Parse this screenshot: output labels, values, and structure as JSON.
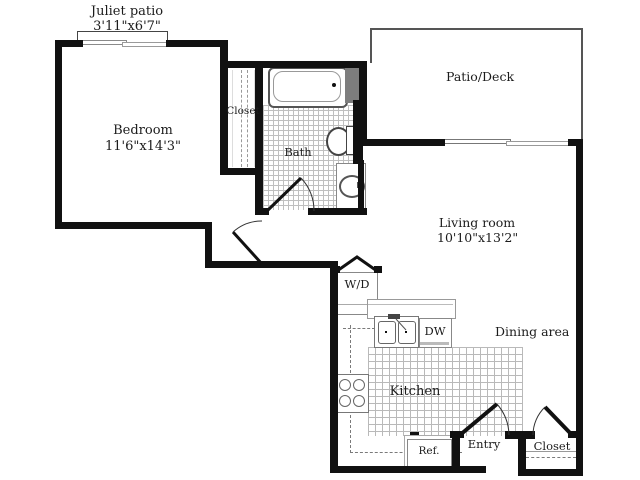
{
  "plan": {
    "juliet_patio": {
      "name": "Juliet patio",
      "dims": "3'11\"x6'7\""
    },
    "bedroom": {
      "name": "Bedroom",
      "dims": "11'6\"x14'3\""
    },
    "bedroom_closet": {
      "name": "Closet"
    },
    "bath": {
      "name": "Bath"
    },
    "patio_deck": {
      "name": "Patio/Deck"
    },
    "living_room": {
      "name": "Living room",
      "dims": "10'10\"x13'2\""
    },
    "laundry": {
      "name": "W/D"
    },
    "dishwasher": {
      "name": "DW"
    },
    "kitchen": {
      "name": "Kitchen"
    },
    "dining_area": {
      "name": "Dining area"
    },
    "refrigerator": {
      "name": "Ref."
    },
    "entry": {
      "name": "Entry"
    },
    "entry_closet": {
      "name": "Closet"
    }
  },
  "colors": {
    "wall": "#111111",
    "tile_line": "#bfbfbf",
    "fixture_line": "#777777",
    "shower_block": "#7d7d7d",
    "background": "#ffffff"
  }
}
